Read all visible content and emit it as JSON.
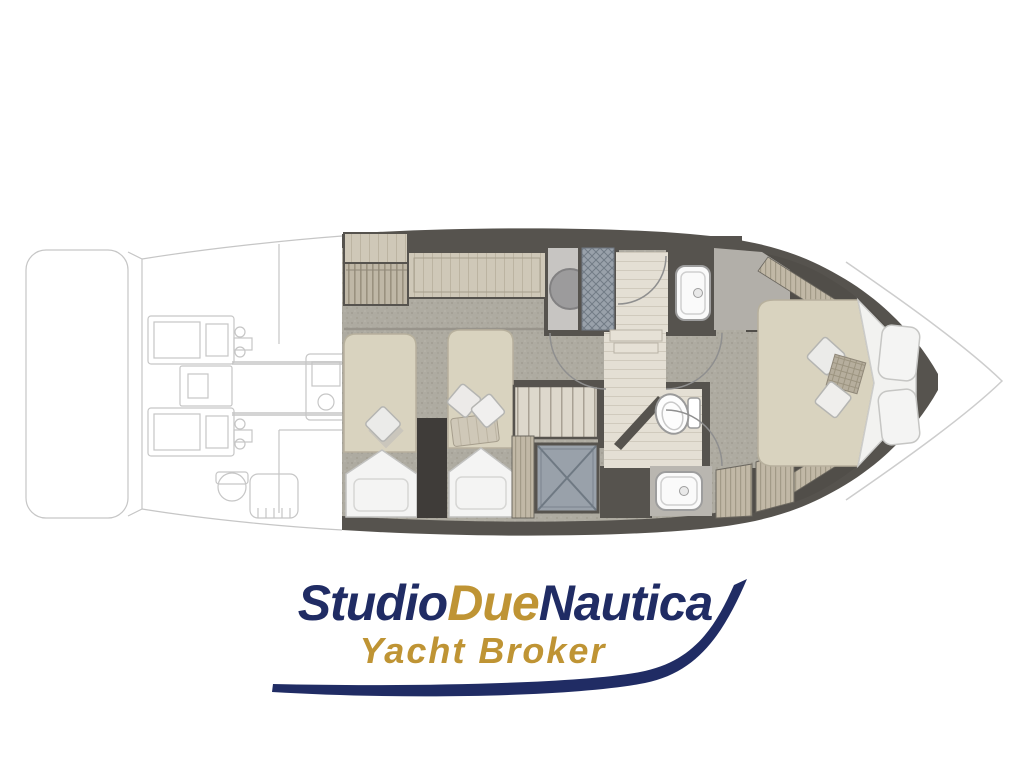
{
  "logo": {
    "brand_part1": "Studio",
    "brand_part2": "Due",
    "brand_part3": "Nautica",
    "tagline": "Yacht Broker"
  },
  "colors": {
    "navy": "#202c64",
    "gold": "#bf9434",
    "wall": "#56534e",
    "carpet": "#aeaba1",
    "bed": "#d9d3bf",
    "wood": "#cfc8b8",
    "woodFloor": "#e4dfd4",
    "shower": "#99a1aa",
    "fixture": "#fafafa",
    "outline": "#c9c9c9"
  }
}
